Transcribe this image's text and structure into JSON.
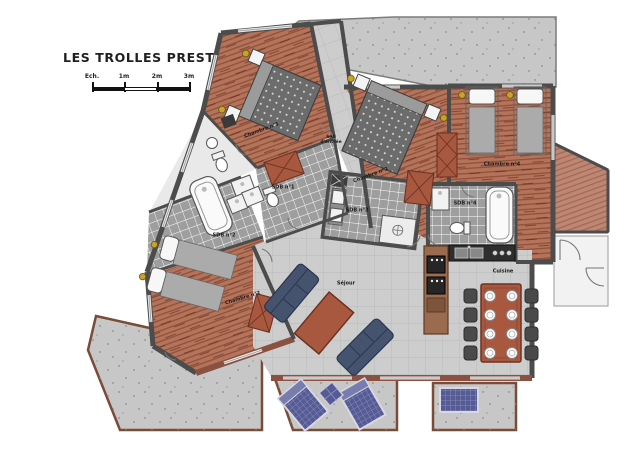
{
  "title": "LES TROLLES PRESTIGE N°3",
  "scale_bar": {
    "label": "Ech.",
    "marks": [
      "1m",
      "2m",
      "3m"
    ]
  },
  "rooms": {
    "chambre1": "Chambre n°1",
    "chambre2": "Chambre n°2",
    "chambre3": "Chambre n°3",
    "chambre4": "Chambre n°4",
    "sdb1": "SDB n°1",
    "sdb2": "SDB n°2",
    "sdb3": "SDB n°3",
    "sdb4": "SDB n°4",
    "cuisine": "Cuisine",
    "sejour": "Séjour",
    "hall_line1": "hall",
    "hall_line2": "d'entrée"
  },
  "colors": {
    "wood": "#b5735a",
    "brick": "#a8583f",
    "concrete": "#c7c7c7",
    "wall_interior": "#4c4c4c",
    "wall_exterior": "#8a5040",
    "bath_tile": "#9e9e9e",
    "living_tile": "#cdcdcd",
    "sofa": "#46536e",
    "lounger": "#565b94",
    "mattress": "#6c6c6c",
    "accent_gold": "#c9a227"
  }
}
